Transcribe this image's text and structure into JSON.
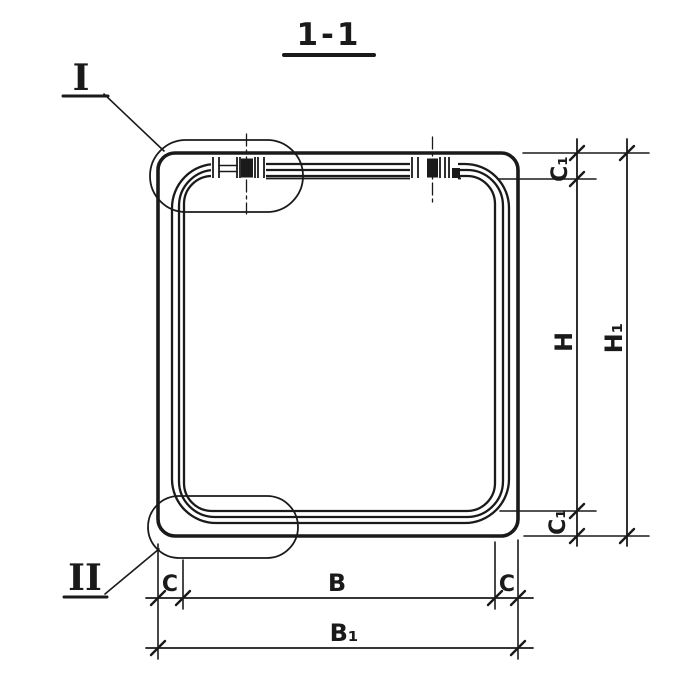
{
  "drawing": {
    "title": "1-1"
  },
  "callouts": {
    "top_detail": "I",
    "bottom_detail": "II"
  },
  "dims": {
    "c_left": "C",
    "b": "B",
    "c_right": "C",
    "b1": "B₁",
    "c1_top": "C₁",
    "h": "H",
    "c1_bottom": "C₁",
    "h1": "H₁"
  },
  "colors": {
    "ink": "#1a1a1a",
    "paper": "#ffffff"
  }
}
